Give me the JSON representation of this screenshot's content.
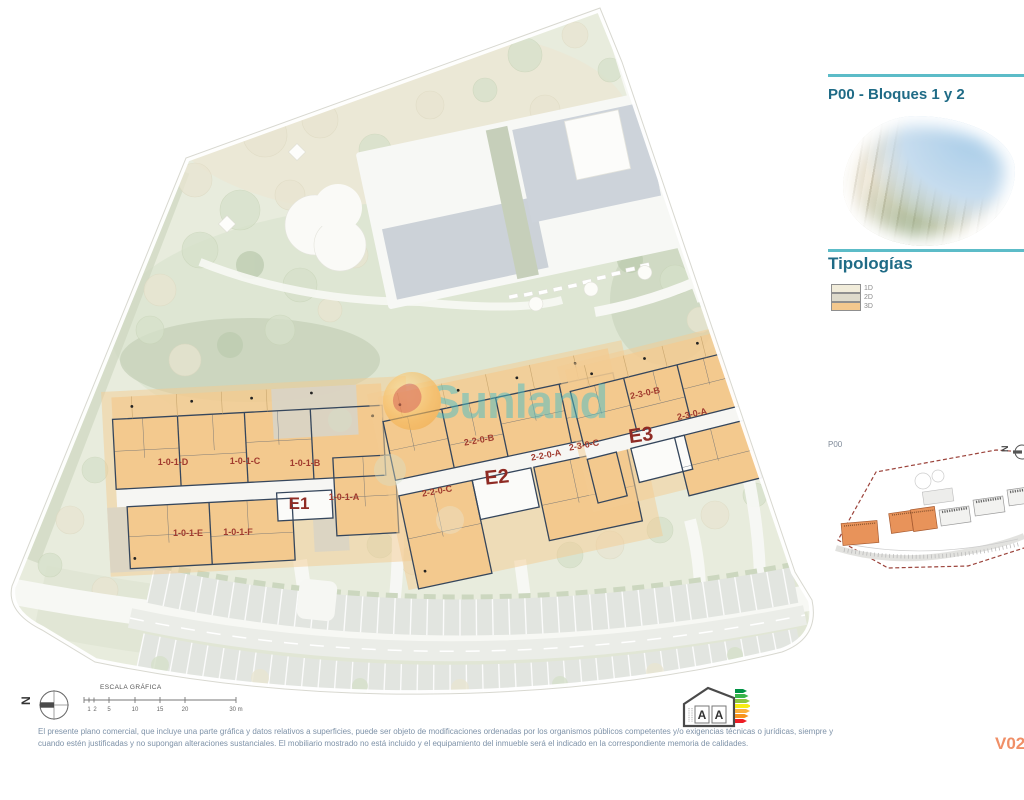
{
  "watermark": {
    "text": "Sunland"
  },
  "sidebar": {
    "title": "P00 - Bloques 1 y 2",
    "section_title": "Tipologías",
    "legend": [
      {
        "label": "1D",
        "color": "#f1ecda"
      },
      {
        "label": "2D",
        "color": "#dedacb"
      },
      {
        "label": "3D",
        "color": "#f3c88e"
      }
    ],
    "minimap": {
      "label": "P00",
      "compass_letter": "N"
    }
  },
  "plan": {
    "blocks": [
      {
        "label": "E1"
      },
      {
        "label": "E2"
      },
      {
        "label": "E3"
      }
    ],
    "units": [
      {
        "label": "1-0-1-D"
      },
      {
        "label": "1-0-1-C"
      },
      {
        "label": "1-0-1-B"
      },
      {
        "label": "1-0-1-A"
      },
      {
        "label": "1-0-1-E"
      },
      {
        "label": "1-0-1-F"
      },
      {
        "label": "2-2-0-B"
      },
      {
        "label": "2-2-0-A"
      },
      {
        "label": "2-3-0-C"
      },
      {
        "label": "2-2-0-C"
      },
      {
        "label": "2-3-0-B"
      },
      {
        "label": "2-3-0-A"
      }
    ]
  },
  "footer": {
    "compass_letter": "N",
    "scale": {
      "title": "ESCALA GRÁFICA",
      "ticks": [
        "1",
        "2",
        "5",
        "10",
        "15",
        "20",
        "30 m"
      ]
    },
    "disclaimer_line1": "El presente plano comercial, que incluye una parte gráfica y datos relativos a superficies, puede ser objeto de modificaciones ordenadas por los organismos públicos competentes y/o exigencias técnicas o jurídicas, siempre y",
    "disclaimer_line2": "cuando estén justificadas y no supongan alteraciones sustanciales. El mobiliario mostrado no está incluido y el equipamiento del inmueble será el indicado en la correspondiente memoria de calidades.",
    "energy": {
      "letters": [
        "A",
        "A"
      ]
    },
    "version": "V02"
  },
  "colors": {
    "accent_teal": "#5cbcc8",
    "heading": "#1f6b86",
    "unit_label": "#a03a2e",
    "block_label": "#8f2b24",
    "typology_3d": "#f3c88e",
    "version_orange": "#f08f67"
  }
}
